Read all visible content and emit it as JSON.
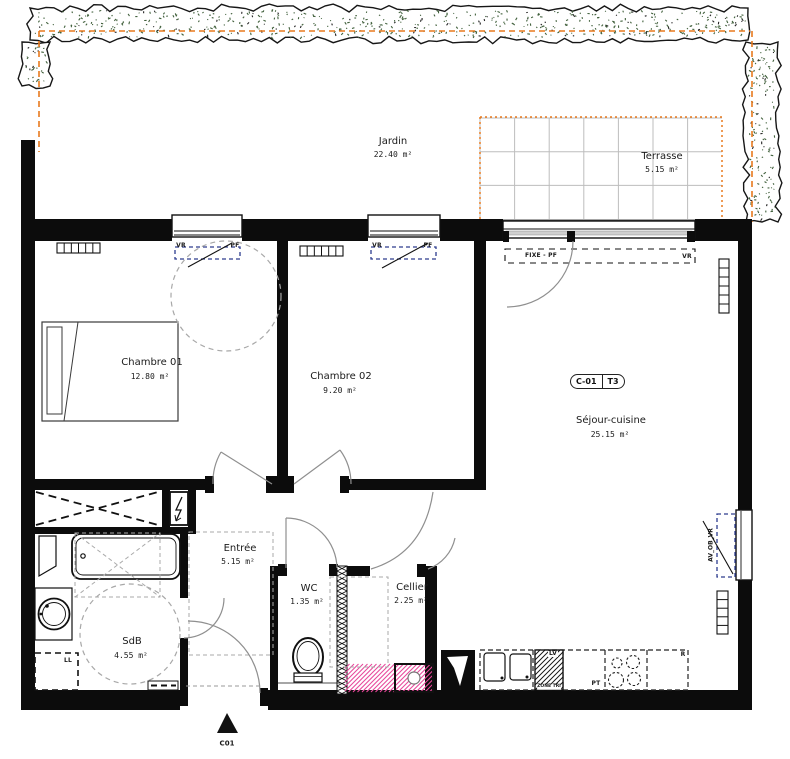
{
  "plan": {
    "rooms": {
      "jardin": {
        "name": "Jardin",
        "area": "22.40 m²"
      },
      "terrasse": {
        "name": "Terrasse",
        "area": "5.15 m²"
      },
      "chambre01": {
        "name": "Chambre 01",
        "area": "12.80 m²"
      },
      "chambre02": {
        "name": "Chambre 02",
        "area": "9.20 m²"
      },
      "sejour": {
        "name": "Séjour-cuisine",
        "area": "25.15 m²"
      },
      "entree": {
        "name": "Entrée",
        "area": "5.15 m²"
      },
      "wc": {
        "name": "WC",
        "area": "1.35 m²"
      },
      "cellier": {
        "name": "Cellier",
        "area": "2.25 m²"
      },
      "sdb": {
        "name": "SdB",
        "area": "4.55 m²"
      }
    },
    "unit_tag": {
      "code": "C-01",
      "type": "T3"
    },
    "windows": {
      "chambre01": {
        "left": "VR",
        "right": "PF"
      },
      "chambre02": {
        "left": "VR",
        "right": "PF"
      },
      "sejour": {
        "left": "FIXE - PF",
        "right": "VR"
      },
      "sejour_side": "AV_OB_VR"
    },
    "kitchen": {
      "dishwasher": "LV",
      "zone": "ZONE TRI",
      "worktop": "PT",
      "fridge": "R"
    },
    "laundry": "LL",
    "section_marker": "C01",
    "colors": {
      "boundary": "#e87a1e",
      "window_annotation": "#2d3c8e",
      "technical_zone": "#e8479b",
      "hedge_green": "#41603c"
    }
  }
}
